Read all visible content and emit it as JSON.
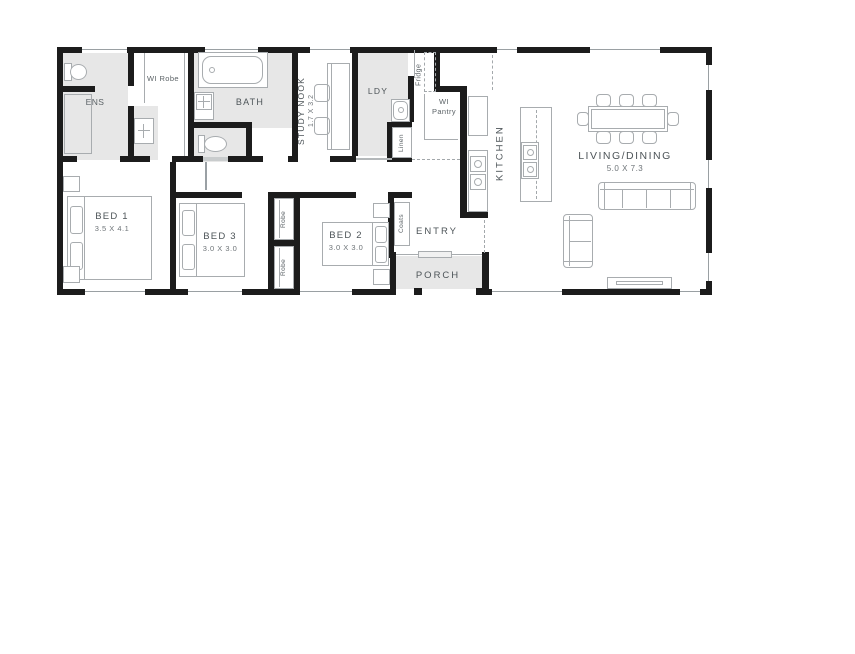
{
  "colors": {
    "wall": "#1c1c1c",
    "room_fill": "#e7e7e7",
    "furniture_line": "#a8acaf",
    "label": "#4d5458",
    "dim_label": "#6e7478",
    "window_line": "#9aa0a3"
  },
  "rooms": {
    "ens": {
      "label": "ENS"
    },
    "wi_robe": {
      "label": "WI Robe"
    },
    "bath": {
      "label": "BATH"
    },
    "study_nook": {
      "label": "STUDY NOOK",
      "dims": "1.7 X 3.2"
    },
    "ldy": {
      "label": "LDY"
    },
    "fridge": {
      "label": "Fridge"
    },
    "wi_pantry": {
      "label": "WI Pantry"
    },
    "linen": {
      "label": "Linen"
    },
    "kitchen": {
      "label": "KITCHEN"
    },
    "living_dining": {
      "label": "LIVING/DINING",
      "dims": "5.0 X 7.3"
    },
    "bed_1": {
      "label": "BED 1",
      "dims": "3.5 X 4.1"
    },
    "bed_3": {
      "label": "BED 3",
      "dims": "3.0 X 3.0"
    },
    "bed_2": {
      "label": "BED 2",
      "dims": "3.0 X 3.0"
    },
    "robe_bed3": {
      "label": "Robe"
    },
    "robe_bed2": {
      "label": "Robe"
    },
    "coats": {
      "label": "Coats"
    },
    "entry": {
      "label": "ENTRY"
    },
    "porch": {
      "label": "PORCH"
    }
  }
}
